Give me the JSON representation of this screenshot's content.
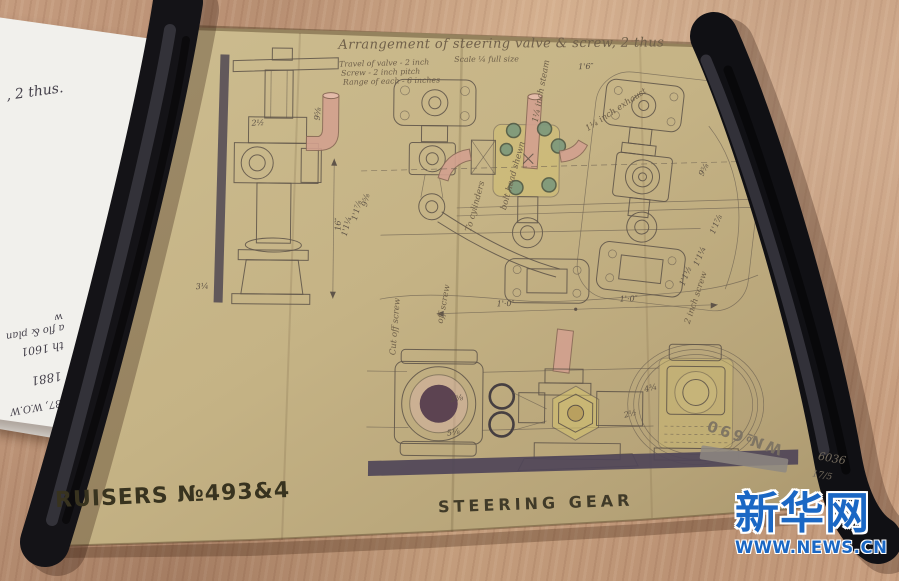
{
  "drawing": {
    "title": "Arrangement of steering valve & screw, 2 thus",
    "scale_note": "Scale ¼ full size",
    "notes": [
      "Travel of valve - 2 inch",
      "Screw - 2 inch pitch",
      "Range of each - 6 inches"
    ],
    "bottom_left_stencil": "RUISERS №493&4",
    "bottom_center_stencil": "STEERING GEAR",
    "corner_stamp": "W№690",
    "pencil_marks": {
      "number": "6036",
      "date": "17/5"
    },
    "labels": [
      {
        "t": "1'·0″",
        "x": 497,
        "y": 306,
        "r": -2,
        "k": "dim"
      },
      {
        "t": "1'·0″",
        "x": 620,
        "y": 300,
        "r": -2,
        "k": "dim"
      },
      {
        "t": "1'6″",
        "x": 576,
        "y": 68,
        "r": -2,
        "k": "dim"
      },
      {
        "t": "16″",
        "x": 340,
        "y": 232,
        "r": -90,
        "k": "dim"
      },
      {
        "t": "9⅝",
        "x": 366,
        "y": 208,
        "r": -78,
        "k": "dim"
      },
      {
        "t": "1'1⅞",
        "x": 356,
        "y": 222,
        "r": -76,
        "k": "dim"
      },
      {
        "t": "1'1¼",
        "x": 346,
        "y": 238,
        "r": -76,
        "k": "dim"
      },
      {
        "t": "2½",
        "x": 250,
        "y": 128,
        "r": -4,
        "k": "dim"
      },
      {
        "t": "3¼",
        "x": 196,
        "y": 292,
        "r": -4,
        "k": "dim"
      },
      {
        "t": "9⅝",
        "x": 318,
        "y": 122,
        "r": -85,
        "k": "dim"
      },
      {
        "t": "9⅝",
        "x": 702,
        "y": 174,
        "r": -64,
        "k": "dim"
      },
      {
        "t": "1'1⅞",
        "x": 714,
        "y": 232,
        "r": -68,
        "k": "dim"
      },
      {
        "t": "1'1¼",
        "x": 698,
        "y": 264,
        "r": -68,
        "k": "dim"
      },
      {
        "t": "1'1½",
        "x": 684,
        "y": 284,
        "r": -68,
        "k": "dim"
      },
      {
        "t": "3⅝",
        "x": 452,
        "y": 402,
        "r": -10,
        "k": "dim"
      },
      {
        "t": "5⅛",
        "x": 449,
        "y": 436,
        "r": -10,
        "k": "dim"
      },
      {
        "t": "4¾",
        "x": 646,
        "y": 390,
        "r": -14,
        "k": "dim"
      },
      {
        "t": "2½",
        "x": 626,
        "y": 416,
        "r": -14,
        "k": "dim"
      },
      {
        "t": "1¼ inch steam",
        "x": 536,
        "y": 122,
        "r": -80,
        "k": "script"
      },
      {
        "t": "1¼ inch exhaust",
        "x": 586,
        "y": 130,
        "r": -34,
        "k": "script"
      },
      {
        "t": "bolt head shewn",
        "x": 505,
        "y": 210,
        "r": -75,
        "k": "script"
      },
      {
        "t": "To cylinders",
        "x": 470,
        "y": 232,
        "r": -75,
        "k": "script"
      },
      {
        "t": "Cut off screw",
        "x": 396,
        "y": 356,
        "r": -86,
        "k": "script"
      },
      {
        "t": "off screw",
        "x": 443,
        "y": 324,
        "r": -80,
        "k": "script"
      },
      {
        "t": "2 inch screw",
        "x": 690,
        "y": 322,
        "r": -72,
        "k": "script"
      }
    ]
  },
  "side_papers": {
    "fragments": [
      ", 2 thus.",
      "a flo & plan w",
      "th 1601",
      "1881",
      "187, W.O.W"
    ]
  },
  "watermark": {
    "logo": "新华网",
    "url": "WWW.NEWS.CN"
  },
  "colors": {
    "table_wood": "#c09878",
    "drawing_paper": "#c7b78a",
    "ink": "#5f5449",
    "pink_pipe": "#d3a18f",
    "yellow_part": "#d5c36e",
    "green_stud": "#7c987c",
    "maroon_bore": "#5c4351",
    "dark_bar": "#4f4558",
    "roller_black": "#141317",
    "watermark_blue": "#1a67c4",
    "white_paper": "#f1f0ec",
    "stencil_ink": "#38331f"
  }
}
